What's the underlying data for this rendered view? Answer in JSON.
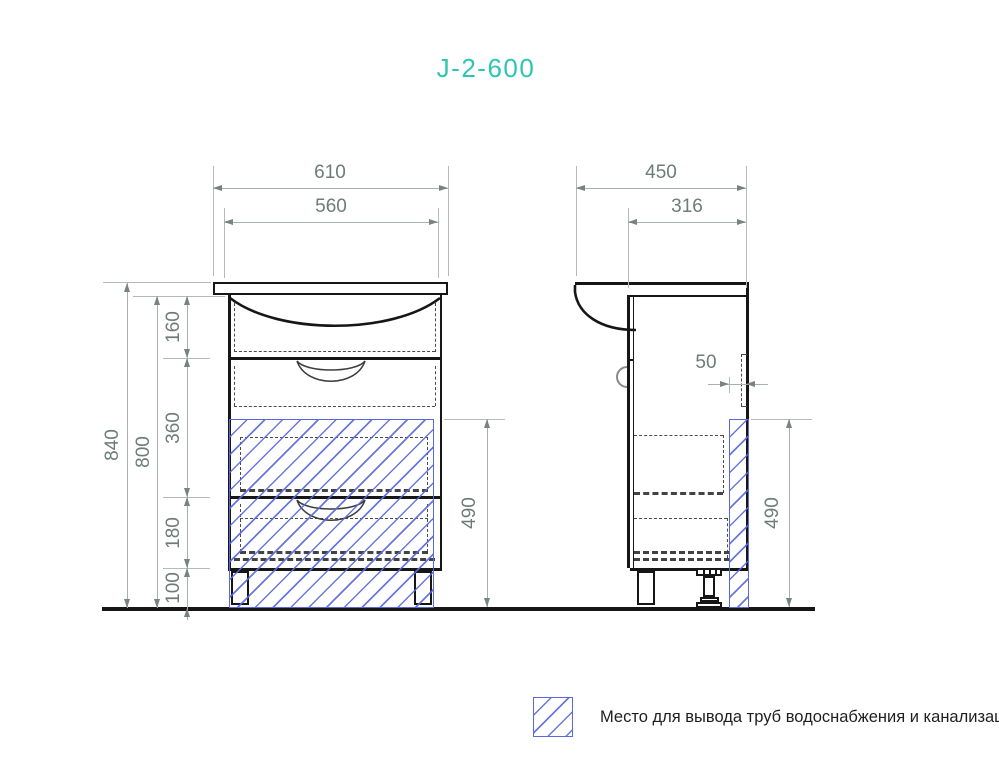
{
  "title": "J-2-600",
  "colors": {
    "accent_teal": "#2cc6b2",
    "hatch_blue": "#5a68dc",
    "outline_black": "#161616",
    "dim_line_gray": "#a9b1ae",
    "dim_text_gray": "#6e7c78"
  },
  "dimensions": {
    "front_width_outer": "610",
    "front_width_inner": "560",
    "side_depth_outer": "450",
    "side_depth_inner": "316",
    "height_total": "840",
    "height_cabinet": "800",
    "segment_sink": "160",
    "segment_drawer1": "360",
    "segment_drawer2": "180",
    "segment_legs": "100",
    "pipe_zone_front": "490",
    "pipe_zone_side": "490",
    "back_gap": "50"
  },
  "legend": {
    "label": "Место для вывода труб водоснабжения и канализации"
  }
}
